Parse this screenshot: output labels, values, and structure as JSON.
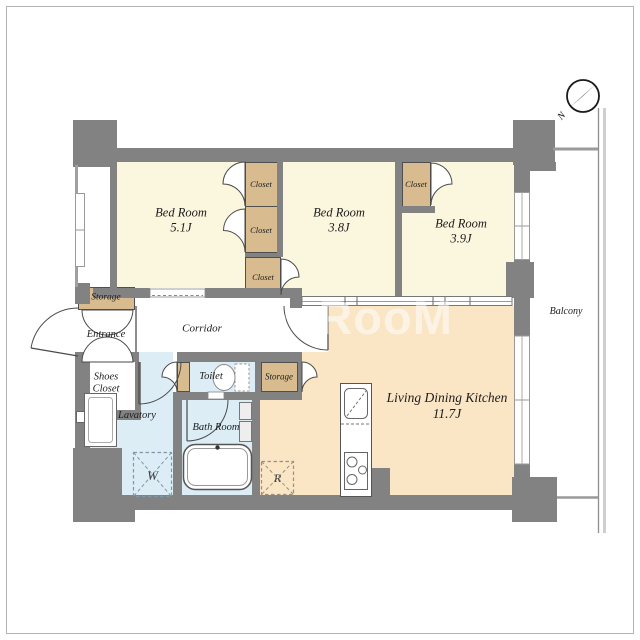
{
  "watermark": "DooRooM",
  "compass": {
    "north_label": "N"
  },
  "balcony": {
    "label": "Balcony"
  },
  "rooms": {
    "bedroom1": {
      "name": "Bed Room",
      "size": "5.1J"
    },
    "bedroom2": {
      "name": "Bed Room",
      "size": "3.8J"
    },
    "bedroom3": {
      "name": "Bed Room",
      "size": "3.9J"
    },
    "ldk": {
      "name": "Living Dining Kitchen",
      "size": "11.7J"
    },
    "corridor": {
      "name": "Corridor"
    },
    "entrance": {
      "name": "Entrance"
    },
    "shoes_closet": {
      "line1": "Shoes",
      "line2": "Closet"
    },
    "toilet": {
      "name": "Toilet"
    },
    "lavatory": {
      "name": "Lavatory"
    },
    "bathroom": {
      "name": "Bath Room"
    }
  },
  "storages": {
    "storage_entrance": "Storage",
    "storage_ldk": "Storage"
  },
  "closets": {
    "closet1": "Closet",
    "closet2": "Closet",
    "closet3": "Closet",
    "closet4": "Closet"
  },
  "appliances": {
    "washer": "W",
    "refrigerator": "R"
  },
  "colors": {
    "wall": "#828282",
    "bedroom_floor": "#FBF6DE",
    "closet_fill": "#D8BC90",
    "wet_floor": "#DCEDF5",
    "ldk_floor": "#FAE5C5",
    "line": "#4a4a4a"
  }
}
